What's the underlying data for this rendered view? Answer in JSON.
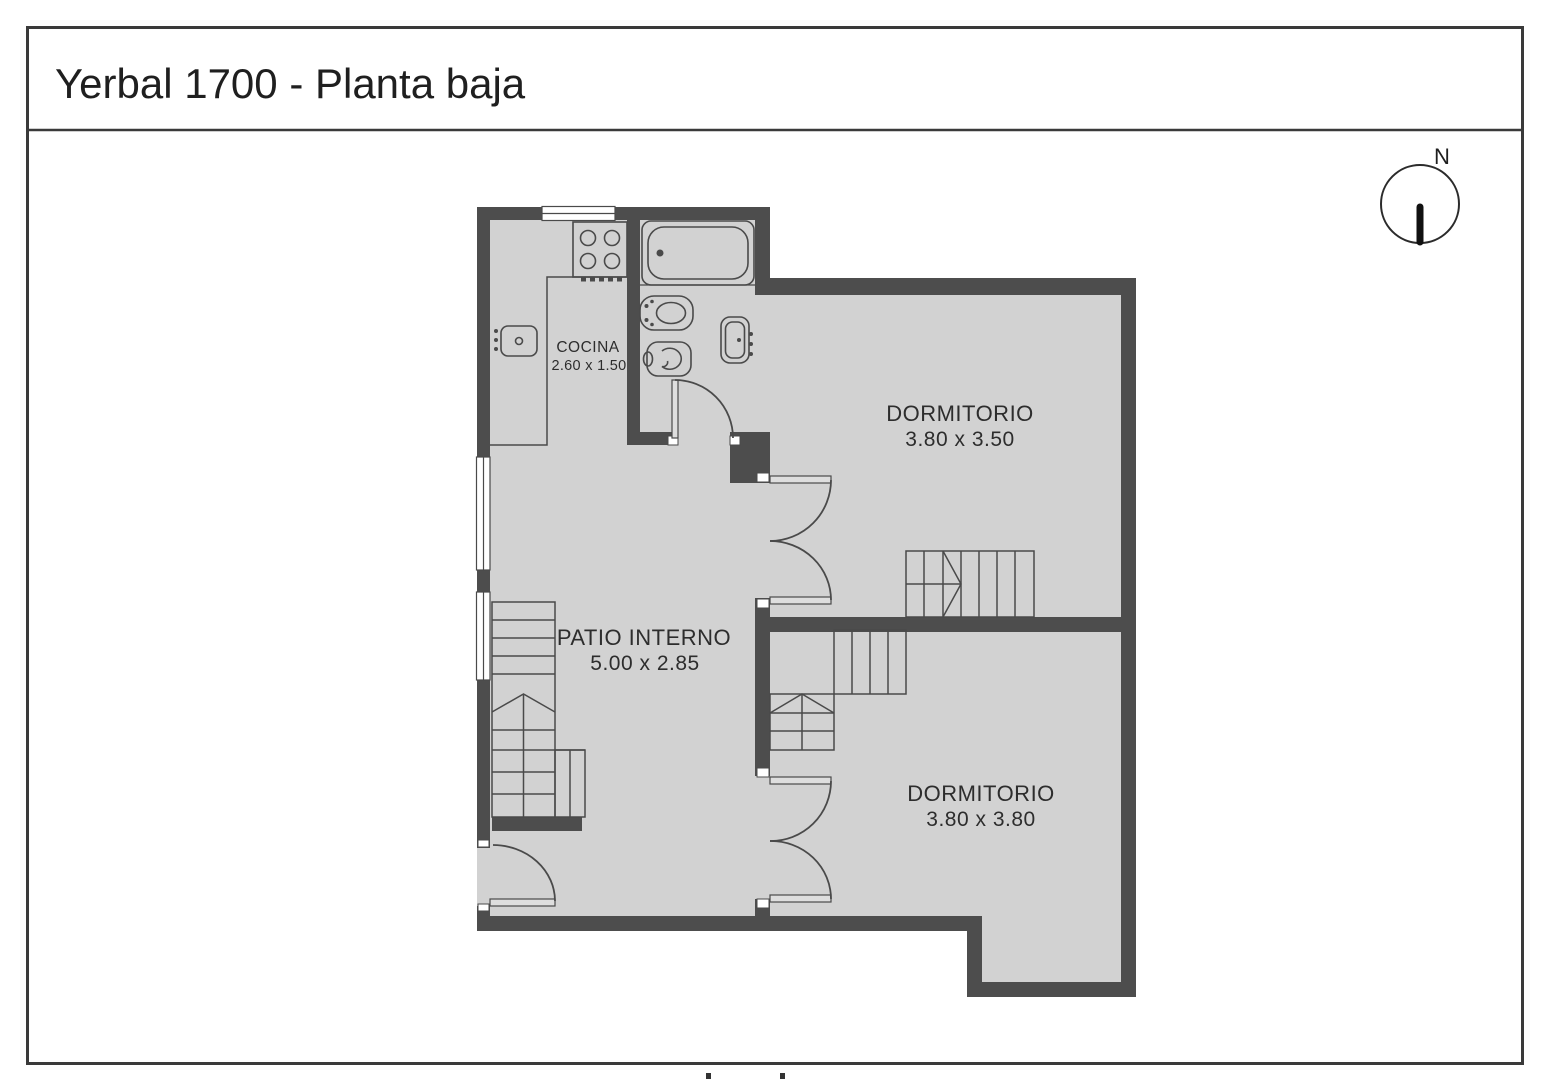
{
  "header": {
    "title": "Yerbal 1700 - Planta baja"
  },
  "compass": {
    "label": "N"
  },
  "plan": {
    "colors": {
      "wall": "#4d4d4d",
      "floor": "#d2d2d2",
      "line": "#4a4a4a",
      "label": "#2d2d2d",
      "frame": "#3a3a3a"
    },
    "rooms": [
      {
        "name": "COCINA",
        "dims": "2.60 x 1.50"
      },
      {
        "name": "DORMITORIO",
        "dims": "3.80 x 3.50"
      },
      {
        "name": "PATIO INTERNO",
        "dims": "5.00 x 2.85"
      },
      {
        "name": "DORMITORIO",
        "dims": "3.80 x 3.80"
      }
    ]
  }
}
